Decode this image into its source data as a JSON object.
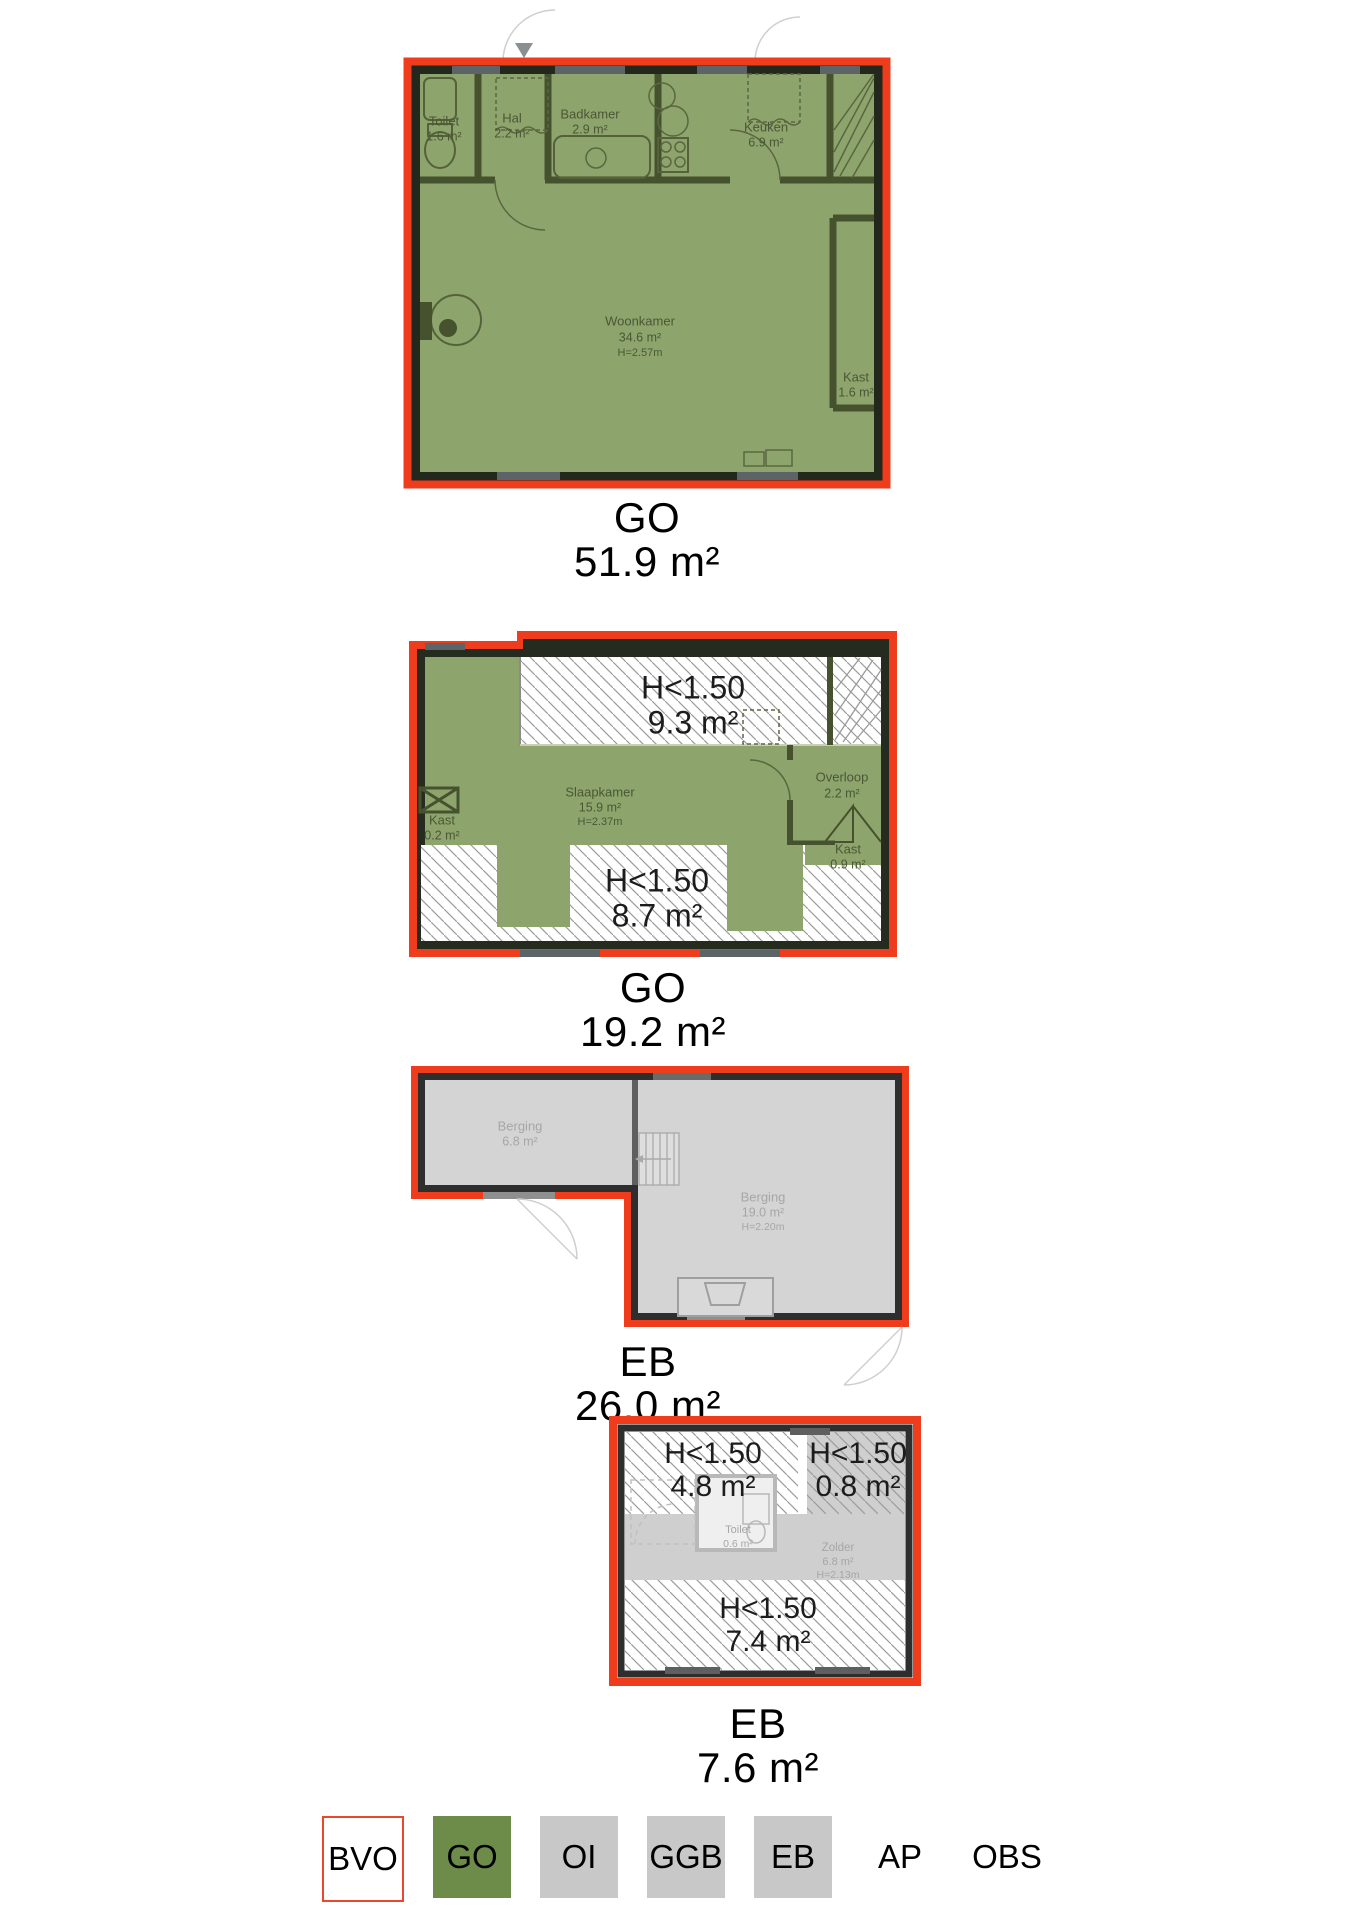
{
  "plans": {
    "floor1": {
      "type_label": "GO",
      "area_label": "51.9 m²",
      "rooms": {
        "toilet": {
          "name": "Toilet",
          "area": "1.6 m²"
        },
        "hal": {
          "name": "Hal",
          "area": "2.2 m²"
        },
        "badkamer": {
          "name": "Badkamer",
          "area": "2.9 m²"
        },
        "keuken": {
          "name": "Keuken",
          "area": "6.9 m²"
        },
        "woonkamer": {
          "name": "Woonkamer",
          "area": "34.6 m²",
          "height": "H=2.57m"
        },
        "kast": {
          "name": "Kast",
          "area": "1.6 m²"
        }
      }
    },
    "floor2": {
      "type_label": "GO",
      "area_label": "19.2 m²",
      "rooms": {
        "h150_top": {
          "name": "H<1.50",
          "area": "9.3 m²"
        },
        "slaapkamer": {
          "name": "Slaapkamer",
          "area": "15.9 m²",
          "height": "H=2.37m"
        },
        "overloop": {
          "name": "Overloop",
          "area": "2.2 m²"
        },
        "kast_left": {
          "name": "Kast",
          "area": "0.2 m²"
        },
        "kast_right": {
          "name": "Kast",
          "area": "0.9 m²"
        },
        "h150_bottom": {
          "name": "H<1.50",
          "area": "8.7 m²"
        }
      }
    },
    "storage": {
      "type_label": "EB",
      "area_label": "26.0 m²",
      "rooms": {
        "berging_small": {
          "name": "Berging",
          "area": "6.8 m²"
        },
        "berging_large": {
          "name": "Berging",
          "area": "19.0 m²",
          "height": "H=2.20m"
        }
      }
    },
    "attic": {
      "type_label": "EB",
      "area_label": "7.6 m²",
      "rooms": {
        "h150_left": {
          "name": "H<1.50",
          "area": "4.8 m²"
        },
        "h150_right": {
          "name": "H<1.50",
          "area": "0.8 m²"
        },
        "toilet": {
          "name": "Toilet",
          "area": "0.6 m²"
        },
        "zolder": {
          "name": "Zolder",
          "area": "6.8 m²",
          "height": "H=2.13m"
        },
        "h150_bottom": {
          "name": "H<1.50",
          "area": "7.4 m²"
        }
      }
    }
  },
  "legend": {
    "items": [
      {
        "label": "BVO"
      },
      {
        "label": "GO"
      },
      {
        "label": "OI"
      },
      {
        "label": "GGB"
      },
      {
        "label": "EB"
      },
      {
        "label": "AP"
      },
      {
        "label": "OBS"
      }
    ]
  },
  "colors": {
    "outline_red": "#ee3c1c",
    "go_fill": "#8ea46d",
    "go_legend": "#6d8c49",
    "eb_fill": "#d4d4d4",
    "legend_gray": "#c8c8c8"
  }
}
